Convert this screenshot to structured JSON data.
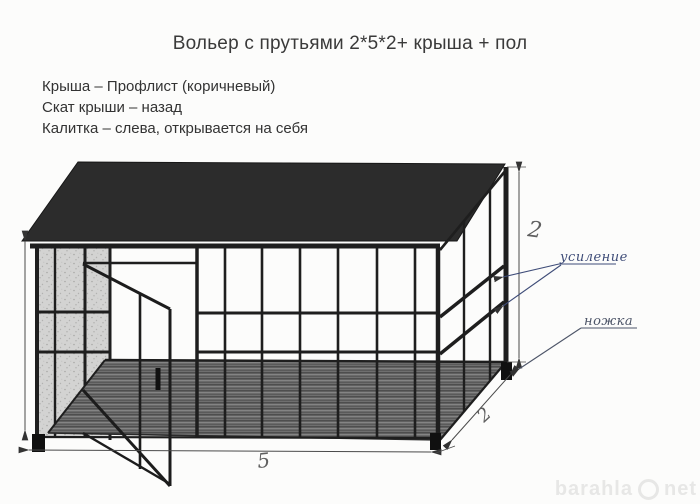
{
  "title": "Вольер с прутьями 2*5*2+ крыша + пол",
  "notes": [
    "Крыша – Профлист (коричневый)",
    "Скат крыши – назад",
    "Калитка – слева, открывается на себя"
  ],
  "annotations": {
    "reinforcement_label": "усиление",
    "leg_label": "ножка",
    "dim_height_right": "2",
    "dim_width_bottom": "5",
    "dim_depth_right": "2"
  },
  "watermark": {
    "site_left": "barahla",
    "site_right": "net"
  },
  "colors": {
    "roof": "#2c2c2c",
    "floor_base": "#6f6f6f",
    "wall_stipple": "#d2d2d2",
    "line_ink": "#1e1e1e",
    "dimension": "#4a4a4a",
    "handwriting_blue": "#3e4c78",
    "handwriting_gray": "#4d5568",
    "watermark": "#e7e7e6"
  }
}
